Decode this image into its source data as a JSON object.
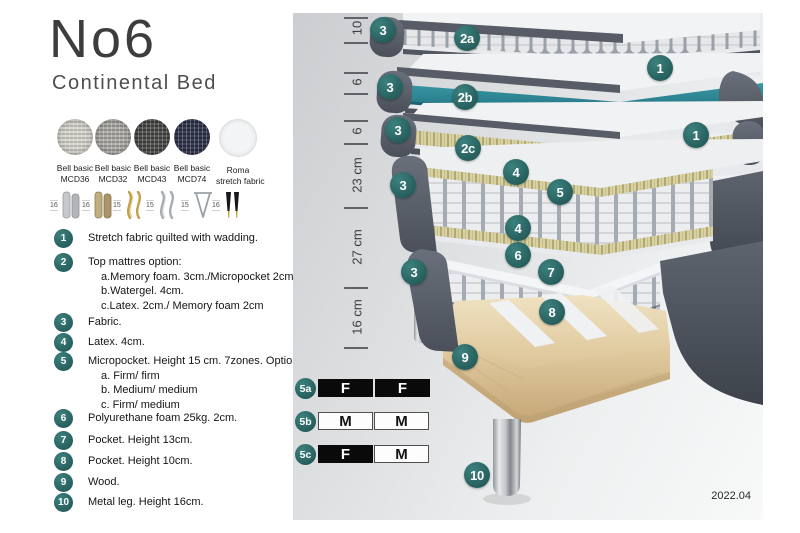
{
  "header": {
    "title": "No6",
    "subtitle": "Continental Bed"
  },
  "fabrics": [
    {
      "line1": "Bell basic",
      "line2": "MCD36",
      "base": "#d8d6d0",
      "dot": "#b7b4ac"
    },
    {
      "line1": "Bell basic",
      "line2": "MCD32",
      "base": "#b0afab",
      "dot": "#8d8c87"
    },
    {
      "line1": "Bell basic",
      "line2": "MCD43",
      "base": "#595957",
      "dot": "#3a3a38"
    },
    {
      "line1": "Bell basic",
      "line2": "MCD74",
      "base": "#3d4257",
      "dot": "#262a3c"
    },
    {
      "line1": "Roma",
      "line2": "stretch fabric",
      "base": "#f3f4f5",
      "dot": "#e8e9ea"
    }
  ],
  "legs": [
    {
      "height": "16"
    },
    {
      "height": "16"
    },
    {
      "height": "15"
    },
    {
      "height": "15"
    },
    {
      "height": "15"
    },
    {
      "height": "16"
    }
  ],
  "legend": [
    {
      "num": "1",
      "text": "Stretch fabric quilted with wadding."
    },
    {
      "num": "2",
      "text": "Top mattres option:",
      "subs": [
        "a.Memory foam. 3cm./Micropocket 2cm",
        "b.Watergel. 4cm.",
        "c.Latex. 2cm./ Memory foam 2cm"
      ]
    },
    {
      "num": "3",
      "text": "Fabric."
    },
    {
      "num": "4",
      "text": "Latex. 4cm."
    },
    {
      "num": "5",
      "text": "Micropocket. Height 15 cm. 7zones. Option:",
      "subs": [
        "a. Firm/ firm",
        "b. Medium/ medium",
        "c. Firm/ medium"
      ]
    },
    {
      "num": "6",
      "text": "Polyurethane foam 25kg. 2cm."
    },
    {
      "num": "7",
      "text": "Pocket. Height 13cm."
    },
    {
      "num": "8",
      "text": "Pocket. Height 10cm."
    },
    {
      "num": "9",
      "text": "Wood."
    },
    {
      "num": "10",
      "text": "Metal leg. Height 16cm."
    }
  ],
  "diagram": {
    "dimensions": [
      {
        "label": "10"
      },
      {
        "label": "6"
      },
      {
        "label": "6"
      },
      {
        "label": "23 cm"
      },
      {
        "label": "27 cm"
      },
      {
        "label": "16 cm"
      }
    ],
    "badges": [
      {
        "label": "3"
      },
      {
        "label": "2a"
      },
      {
        "label": "1"
      },
      {
        "label": "3"
      },
      {
        "label": "2b"
      },
      {
        "label": "1"
      },
      {
        "label": "3"
      },
      {
        "label": "2c"
      },
      {
        "label": "4"
      },
      {
        "label": "3"
      },
      {
        "label": "5"
      },
      {
        "label": "4"
      },
      {
        "label": "6"
      },
      {
        "label": "7"
      },
      {
        "label": "3"
      },
      {
        "label": "8"
      },
      {
        "label": "9"
      },
      {
        "label": "10"
      }
    ],
    "firmness": [
      {
        "id": "5a",
        "cells": [
          {
            "label": "F",
            "fill": "dark"
          },
          {
            "label": "F",
            "fill": "dark"
          }
        ]
      },
      {
        "id": "5b",
        "cells": [
          {
            "label": "M",
            "fill": "light"
          },
          {
            "label": "M",
            "fill": "light"
          }
        ]
      },
      {
        "id": "5c",
        "cells": [
          {
            "label": "F",
            "fill": "dark"
          },
          {
            "label": "M",
            "fill": "light"
          }
        ]
      }
    ],
    "version": "2022.04",
    "colors": {
      "badge_teal": "#2e6f6d",
      "layer_teal": "#2a7f8e",
      "fabric_dark_gray": "#565b64",
      "latex_yellow": "#d7d1a3",
      "wood": "#e2cda0"
    }
  }
}
